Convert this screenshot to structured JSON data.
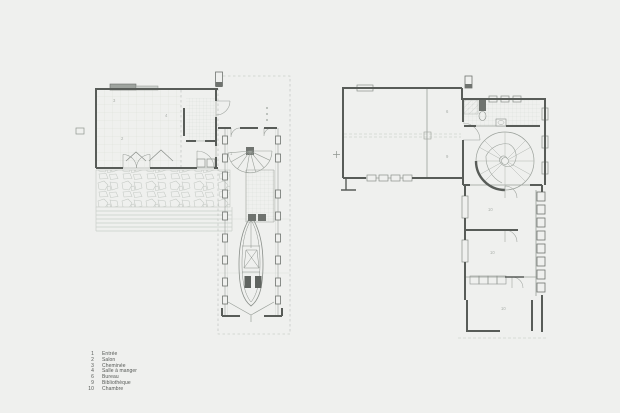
{
  "colors": {
    "background": "#eff0ee",
    "wall": "#585c58",
    "line_medium": "#8f948f",
    "line_light": "#c4c9c4",
    "grid": "#d9ddd8",
    "room_label": "#a9aea9",
    "legend_text": "#555855",
    "dark_fill": "#6f736f"
  },
  "legend": {
    "items": [
      {
        "num": "1",
        "label": "Entrée"
      },
      {
        "num": "2",
        "label": "Salon"
      },
      {
        "num": "3",
        "label": "Cheminée"
      },
      {
        "num": "4",
        "label": "Salle à manger"
      },
      {
        "num": "6",
        "label": "Bureau"
      },
      {
        "num": "9",
        "label": "Bibliothèque"
      },
      {
        "num": "10",
        "label": "Chambre"
      }
    ]
  },
  "rooms": {
    "ground": {
      "entree": "1",
      "salon": "2",
      "cheminee": "3",
      "salle_a_manger": "4"
    },
    "upper": {
      "bureau": "6",
      "bibliotheque": "9",
      "chambre_1": "10",
      "chambre_2": "10",
      "chambre_3": "10"
    }
  }
}
